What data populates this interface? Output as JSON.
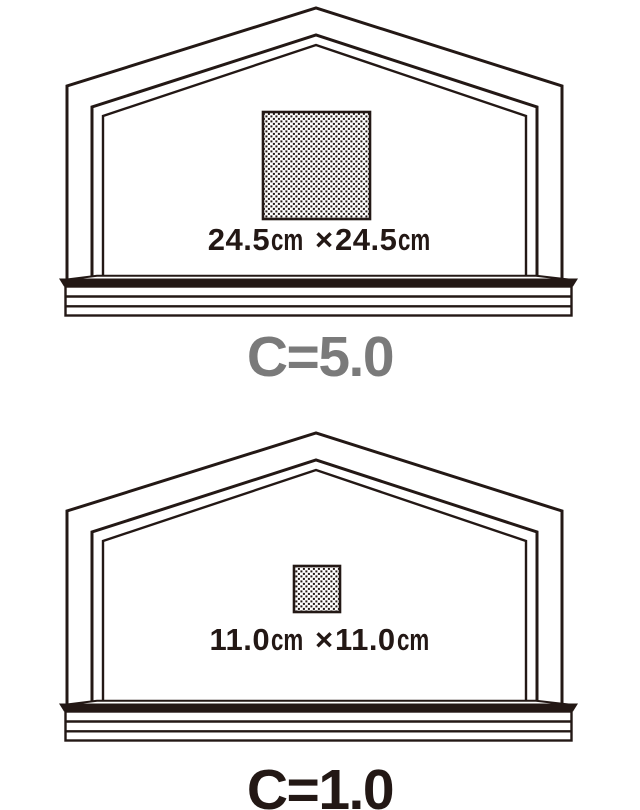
{
  "colors": {
    "ink": "#231815",
    "background": "#ffffff",
    "caption_gray": "#7a7a7a",
    "caption_dark": "#231815"
  },
  "figures": [
    {
      "id": "c5",
      "caption": "C=5.0",
      "caption_color": "#7a7a7a",
      "dimension": {
        "width": "24.5",
        "unit": "cm",
        "times": "×",
        "height": "24.5"
      },
      "square_px": {
        "x": 263,
        "y": 112,
        "width": 107,
        "height": 107
      }
    },
    {
      "id": "c1",
      "caption": "C=1.0",
      "caption_color": "#231815",
      "dimension": {
        "width": "11.0",
        "unit": "cm",
        "times": "×",
        "height": "11.0"
      },
      "square_px": {
        "x": 294,
        "y": 566,
        "width": 46,
        "height": 46
      }
    }
  ]
}
